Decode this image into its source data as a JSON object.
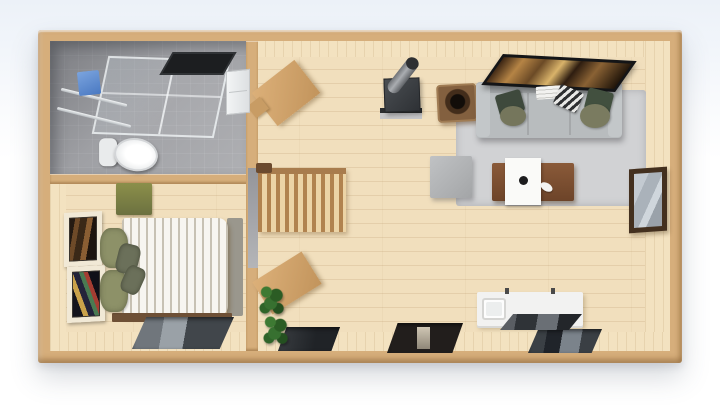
{
  "scene": {
    "description": "3D top-down architectural render of a small wooden cabin interior with bathroom, bedroom and open living room",
    "rooms": [
      {
        "id": "bathroom",
        "label": "bathroom"
      },
      {
        "id": "bedroom",
        "label": "bedroom"
      },
      {
        "id": "living-room",
        "label": "living room"
      }
    ],
    "counts": {
      "rooms": 3,
      "floor_windows": 4,
      "wall_art_frames": 2,
      "plants": 2,
      "sofa_seat_sections": 3
    },
    "palette": {
      "sky_top": "#ecf1f8",
      "wall_wood": "#d6ae7b",
      "wall_face": "#f3e2c0",
      "floor_wood": "#f1dfbd",
      "bath_tile": "#a4a5a9",
      "rug": "#d1d2d4",
      "sofa": "#b8bcbe",
      "sofa_back": "#a7abad",
      "pillow_dark_green": "#3e493c",
      "pillow_olive": "#8d9168",
      "tv_frame": "#141517",
      "stove": "#3d4145",
      "stove_pipe": "#86898d",
      "log_table": "#83603f",
      "coffee_table": "#7d5133",
      "tray_white": "#fafaf8",
      "ottoman": "#b2b4b6",
      "window_frame": "#43301f",
      "glass": "#b9c0c7",
      "bed_duvet": "#f7f5f0",
      "bed_footboard": "#9a978d",
      "bed_frame": "#6e5036",
      "bench_green": "#7b8045",
      "plant_green": "#2f6429",
      "stairs_wood": "#caa06b",
      "skylight_dark": "#2b2e31",
      "toilet_white": "#f2f3f4",
      "towel_blue": "#5c8cd0",
      "art_frame_cream": "#f1e9d6",
      "sideboard_white": "#f2f2f1"
    },
    "furniture": [
      "bathroom-skylight",
      "shower-enclosure",
      "blue-towel",
      "towel-bars",
      "toilet",
      "bathroom-cabinet",
      "wall-art-upper",
      "wall-art-lower",
      "bed",
      "bed-pillows",
      "headboard-bench",
      "bed-frame",
      "staircase",
      "stairwell-opening",
      "corner-desk",
      "writing-desk",
      "potted-plant-1",
      "potted-plant-2",
      "wood-stove",
      "stove-pipe",
      "log-side-table",
      "wall-tv",
      "sofa",
      "sofa-pillows",
      "area-rug",
      "ottoman",
      "coffee-table",
      "serving-tray",
      "coffee-mug",
      "saucer",
      "side-wall-window",
      "white-sideboard",
      "sink",
      "glass-panel",
      "floor-window-bedroom",
      "floor-window-2",
      "floor-window-3",
      "floor-window-4"
    ]
  }
}
